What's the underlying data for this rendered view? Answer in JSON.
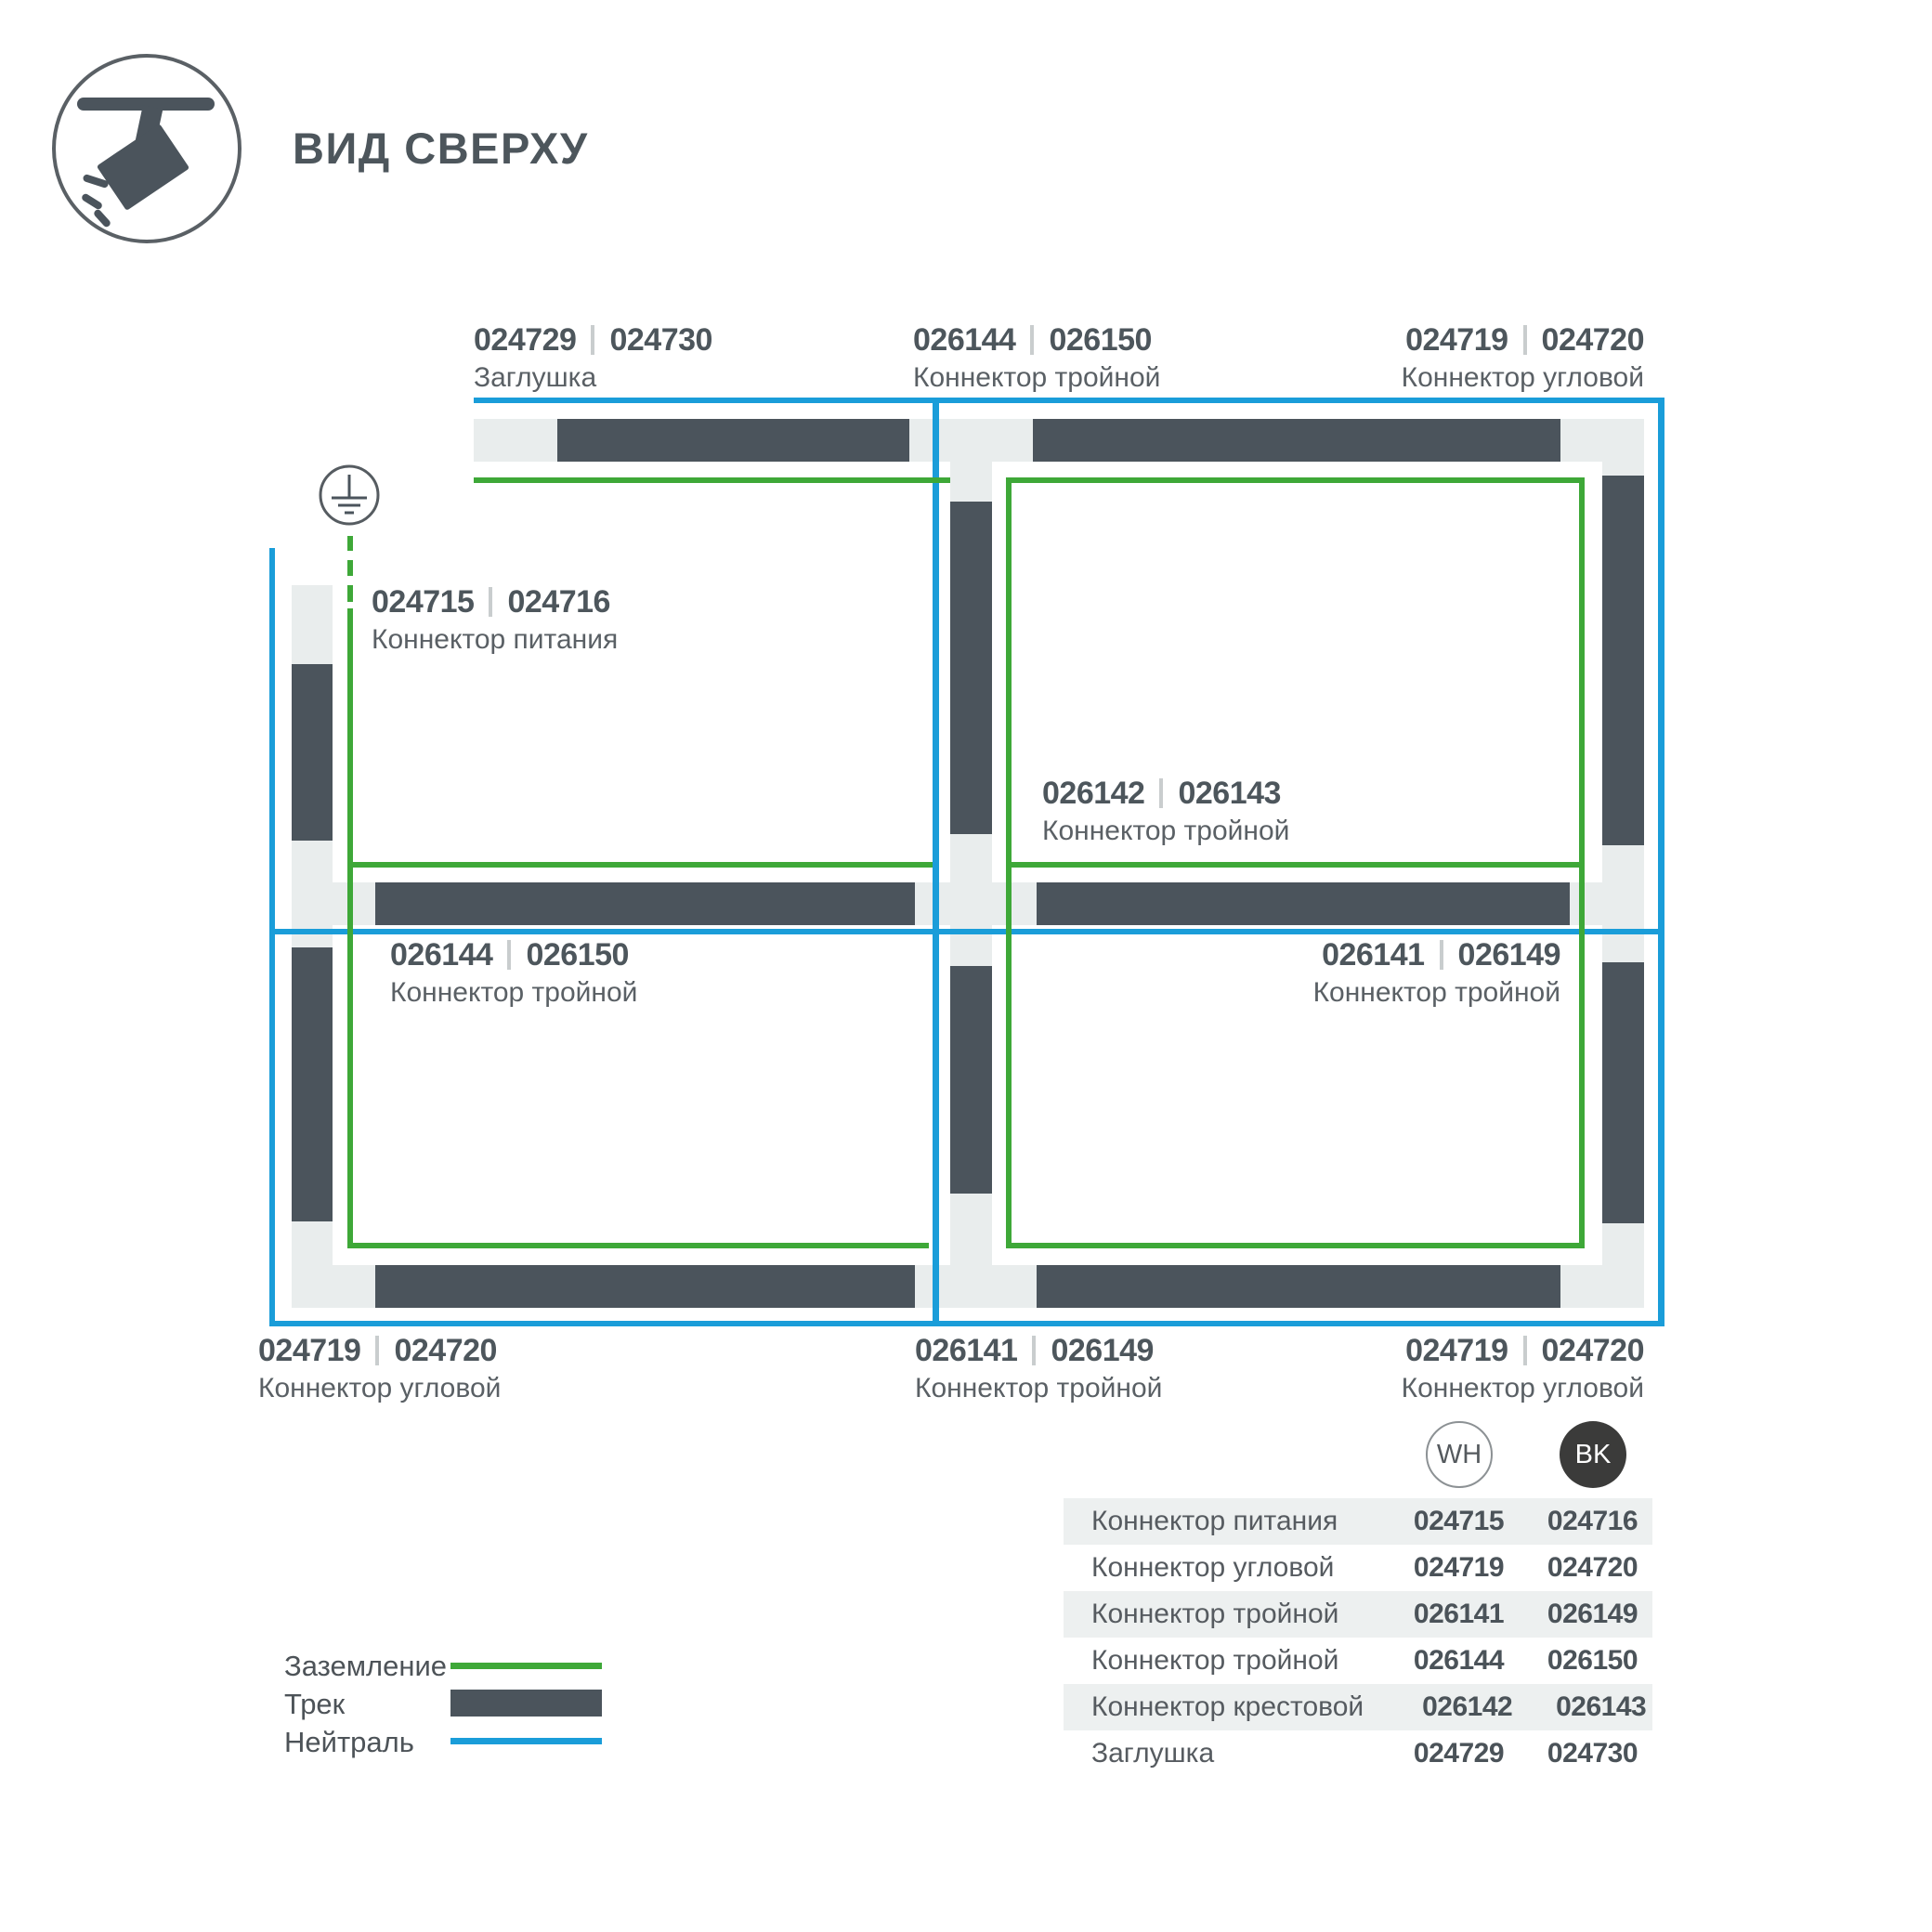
{
  "header": {
    "title": "ВИД СВЕРХУ",
    "icon": "track-spotlight-icon"
  },
  "diagram": {
    "callouts": {
      "top_left": {
        "code_wh": "024729",
        "code_bk": "024730",
        "name": "Заглушка"
      },
      "top_center": {
        "code_wh": "026144",
        "code_bk": "026150",
        "name": "Коннектор тройной"
      },
      "top_right": {
        "code_wh": "024719",
        "code_bk": "024720",
        "name": "Коннектор угловой"
      },
      "power": {
        "code_wh": "024715",
        "code_bk": "024716",
        "name": "Коннектор питания"
      },
      "center": {
        "code_wh": "026142",
        "code_bk": "026143",
        "name": "Коннектор тройной"
      },
      "mid_left": {
        "code_wh": "026144",
        "code_bk": "026150",
        "name": "Коннектор тройной"
      },
      "mid_right": {
        "code_wh": "026141",
        "code_bk": "026149",
        "name": "Коннектор тройной"
      },
      "bottom_left": {
        "code_wh": "024719",
        "code_bk": "024720",
        "name": "Коннектор угловой"
      },
      "bottom_center": {
        "code_wh": "026141",
        "code_bk": "026149",
        "name": "Коннектор тройной"
      },
      "bottom_right": {
        "code_wh": "024719",
        "code_bk": "024720",
        "name": "Коннектор угловой"
      }
    }
  },
  "legend": {
    "items": [
      {
        "label": "Заземление",
        "type": "ground-green-line"
      },
      {
        "label": "Трек",
        "type": "track-dark-bar"
      },
      {
        "label": "Нейтраль",
        "type": "neutral-blue-line"
      }
    ]
  },
  "badges": {
    "wh": "WH",
    "bk": "BK"
  },
  "table": {
    "rows": [
      {
        "name": "Коннектор питания",
        "wh": "024715",
        "bk": "024716"
      },
      {
        "name": "Коннектор угловой",
        "wh": "024719",
        "bk": "024720"
      },
      {
        "name": "Коннектор тройной",
        "wh": "026141",
        "bk": "026149"
      },
      {
        "name": "Коннектор тройной",
        "wh": "026144",
        "bk": "026150"
      },
      {
        "name": "Коннектор крестовой",
        "wh": "026142",
        "bk": "026143"
      },
      {
        "name": "Заглушка",
        "wh": "024729",
        "bk": "024730"
      }
    ]
  },
  "colors": {
    "track": "#4b545c",
    "connector": "#e9eded",
    "ground_green": "#3ea838",
    "neutral_blue": "#1a9dd9",
    "text_dark": "#4d565c",
    "text_mid": "#5a6065"
  }
}
